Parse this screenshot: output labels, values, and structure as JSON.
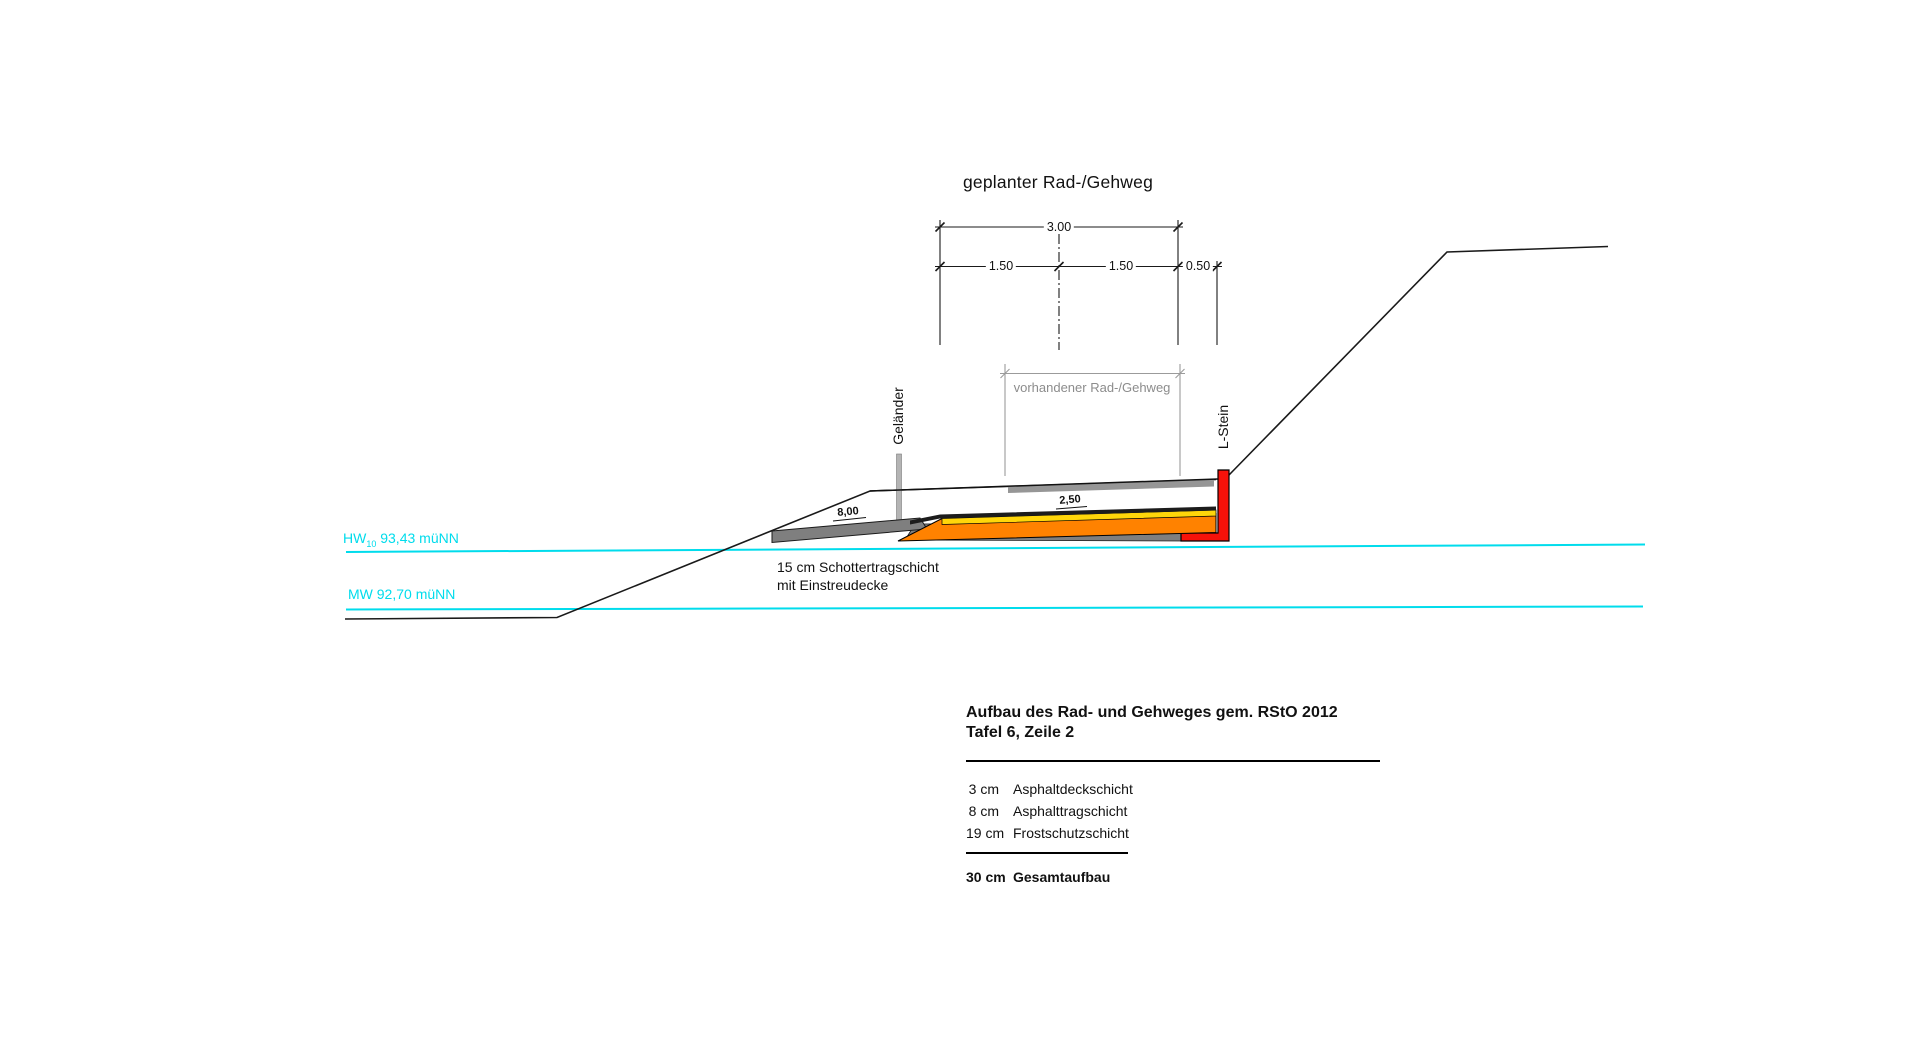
{
  "drawing_title": "geplanter Rad-/Gehweg",
  "dimensions": {
    "overall": "3.00",
    "lane_left": "1.50",
    "lane_right": "1.50",
    "edge_strip": "0.50",
    "existing_path": "vorhandener Rad-/Gehweg",
    "ramp_length": "8,00",
    "cross_slope": "2,50"
  },
  "labels": {
    "railing": "Geländer",
    "l_stone": "L-Stein",
    "note_line1": "15 cm Schottertragschicht",
    "note_line2": "mit Einstreudecke"
  },
  "water_levels": {
    "hw_prefix": "HW",
    "hw_sub": "10",
    "hw_value": " 93,43 müNN",
    "mw": "MW 92,70 müNN"
  },
  "buildup_table": {
    "title_line1": "Aufbau des Rad- und Gehweges gem. RStO 2012",
    "title_line2": "Tafel 6, Zeile 2",
    "rows": [
      {
        "qty": "3 cm",
        "label": "Asphaltdeckschicht"
      },
      {
        "qty": "8 cm",
        "label": "Asphalttragschicht"
      },
      {
        "qty": "19 cm",
        "label": "Frostschutzschicht"
      }
    ],
    "total_qty": "30 cm",
    "total_label": "Gesamtaufbau"
  },
  "colors": {
    "water": "#00dcec",
    "terrain": "#1a1a1a",
    "asphalt_deck": "#1c1c1c",
    "asphalt_base": "#ffd60a",
    "frost_layer": "#ff8200",
    "l_stone": "#f6120a",
    "gravel": "#7f7f7f",
    "existing_bar": "#969696",
    "bracket_gray": "#9b9b9b",
    "railing_post": "#b4b4b4"
  }
}
